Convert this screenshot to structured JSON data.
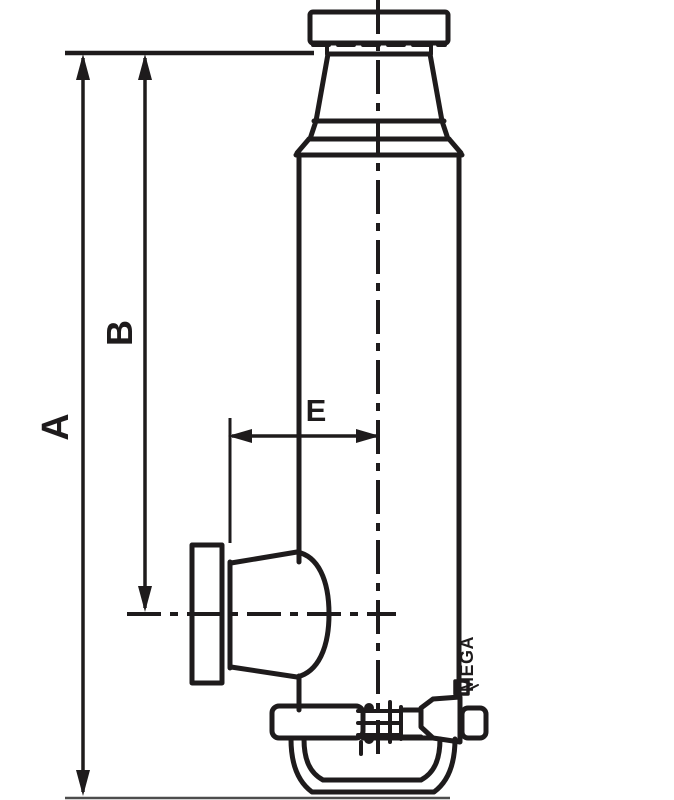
{
  "diagram": {
    "type": "technical-drawing",
    "subject": "hydraulic bottle jack side view with dimension callouts",
    "dimension_labels": {
      "a": "A",
      "b": "B",
      "e": "E"
    },
    "brand_text": "MEGA",
    "colors": {
      "line": "#1e1b1c",
      "background": "#ffffff",
      "ground_line": "#4d4d4d"
    }
  }
}
